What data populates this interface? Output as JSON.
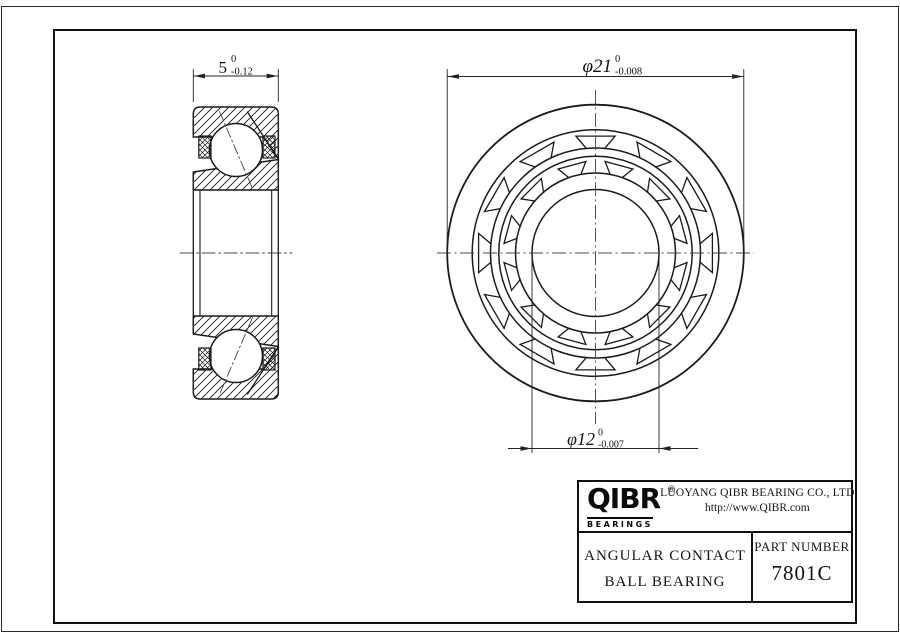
{
  "drawing": {
    "dim_width": {
      "value": "5",
      "tol_upper": "0",
      "tol_lower": "-0.12"
    },
    "dim_od": {
      "value": "φ21",
      "tol_upper": "0",
      "tol_lower": "-0.008"
    },
    "dim_bore": {
      "value": "φ12",
      "tol_upper": "0",
      "tol_lower": "-0.007"
    }
  },
  "title_block": {
    "logo": {
      "text": "QIBR",
      "registered": "®",
      "subtext": "BEARINGS"
    },
    "company": "LUOYANG QIBR BEARING CO., LTD",
    "website": "http://www.QIBR.com",
    "product_line1": "ANGULAR CONTACT",
    "product_line2": "BALL BEARING",
    "part_number_label": "PART NUMBER",
    "part_number": "7801C"
  },
  "colors": {
    "line": "#1a1a1a",
    "centerline": "#444444",
    "background": "#ffffff"
  }
}
